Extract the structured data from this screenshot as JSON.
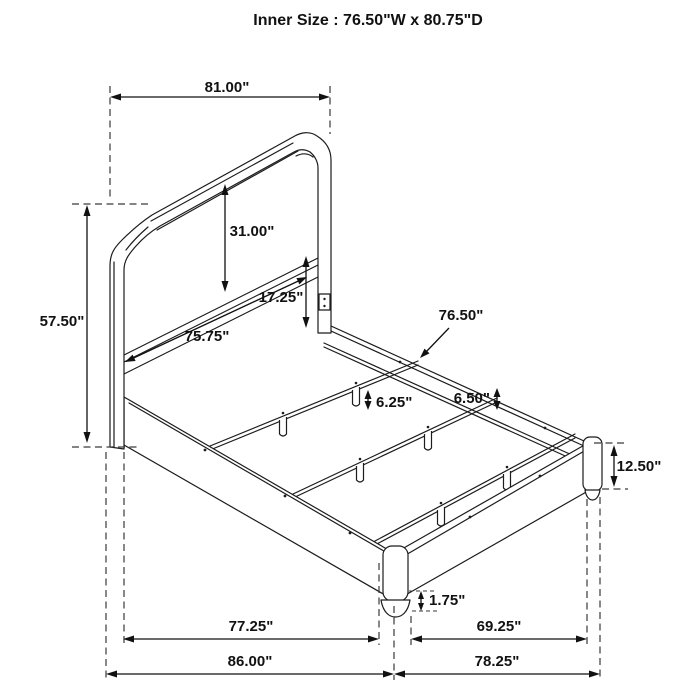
{
  "title": "Inner Size : 76.50\"W x 80.75\"D",
  "diagram": {
    "type": "technical-dimension-drawing",
    "subject": "bed frame with camelback headboard, side rails, footboard rails and three support slats",
    "labels": {
      "headboard_width": "81.00\"",
      "headboard_height": "57.50\"",
      "panel_height": "31.00\"",
      "rail_mount_height": "17.25\"",
      "headboard_inner_width": "75.75\"",
      "slat_length": "76.50\"",
      "rail_ledge_depth": "6.50\"",
      "slat_leg_height": "6.25\"",
      "side_rail_height": "12.50\"",
      "foot_height": "1.75\"",
      "rail_span_inner": "77.25\"",
      "overall_depth": "86.00\"",
      "footboard_span_inner": "69.25\"",
      "overall_width": "78.25\""
    }
  }
}
